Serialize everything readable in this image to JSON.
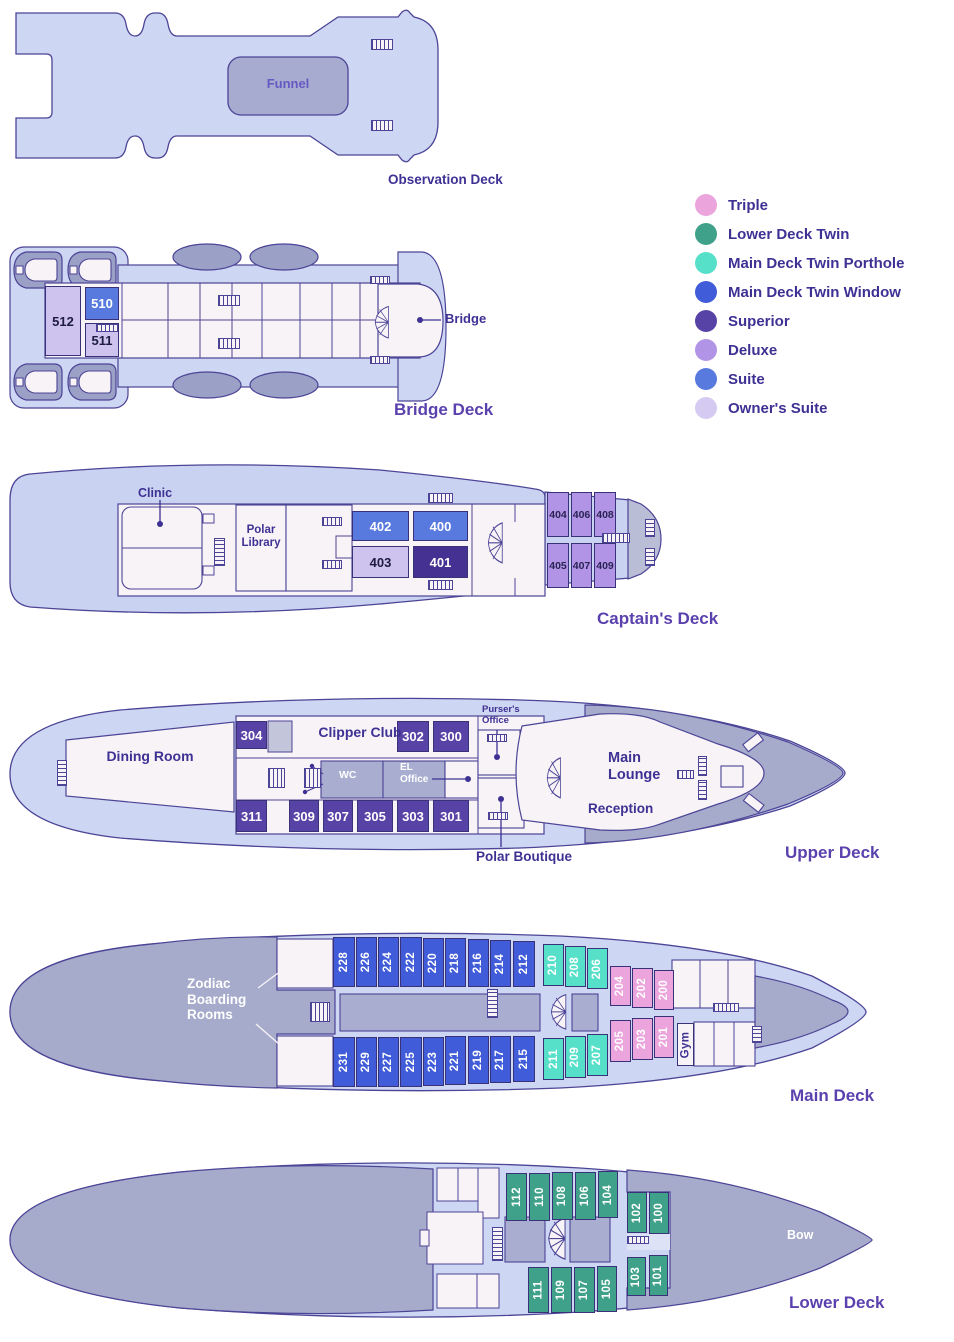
{
  "legend": {
    "items": [
      {
        "label": "Triple",
        "color": "#eba4dc"
      },
      {
        "label": "Lower Deck Twin",
        "color": "#3fa189"
      },
      {
        "label": "Main Deck Twin Porthole",
        "color": "#57e0c9"
      },
      {
        "label": "Main Deck Twin Window",
        "color": "#415cd8"
      },
      {
        "label": "Superior",
        "color": "#5743a6"
      },
      {
        "label": "Deluxe",
        "color": "#b294e6"
      },
      {
        "label": "Suite",
        "color": "#5879de"
      },
      {
        "label": "Owner's Suite",
        "color": "#d5cbf2"
      }
    ]
  },
  "decks": {
    "observation": {
      "title": "Observation Deck",
      "funnel": "Funnel"
    },
    "bridge": {
      "title": "Bridge Deck",
      "bridge_label": "Bridge",
      "cabins": [
        {
          "number": "510",
          "category": "Suite"
        },
        {
          "number": "511",
          "category": "Owner's Suite"
        },
        {
          "number": "512",
          "category": "Owner's Suite"
        }
      ]
    },
    "captains": {
      "title": "Captain's Deck",
      "clinic": "Clinic",
      "polar_library": "Polar Library",
      "cabins": [
        {
          "number": "400",
          "category": "Suite"
        },
        {
          "number": "401",
          "category": "Superior"
        },
        {
          "number": "402",
          "category": "Suite"
        },
        {
          "number": "403",
          "category": "Owner's Suite"
        },
        {
          "number": "404",
          "category": "Deluxe"
        },
        {
          "number": "405",
          "category": "Deluxe"
        },
        {
          "number": "406",
          "category": "Deluxe"
        },
        {
          "number": "407",
          "category": "Deluxe"
        },
        {
          "number": "408",
          "category": "Deluxe"
        },
        {
          "number": "409",
          "category": "Deluxe"
        }
      ]
    },
    "upper": {
      "title": "Upper Deck",
      "dining_room": "Dining Room",
      "clipper_club": "Clipper Club",
      "wc": "WC",
      "el_office": "EL Office",
      "pursers_office": "Purser's Office",
      "main_lounge": "Main Lounge",
      "reception": "Reception",
      "polar_boutique": "Polar Boutique",
      "cabins": [
        {
          "number": "300",
          "category": "Superior"
        },
        {
          "number": "301",
          "category": "Superior"
        },
        {
          "number": "302",
          "category": "Superior"
        },
        {
          "number": "303",
          "category": "Superior"
        },
        {
          "number": "304",
          "category": "Superior"
        },
        {
          "number": "305",
          "category": "Superior"
        },
        {
          "number": "307",
          "category": "Superior"
        },
        {
          "number": "309",
          "category": "Superior"
        },
        {
          "number": "311",
          "category": "Superior"
        }
      ]
    },
    "main": {
      "title": "Main Deck",
      "zodiac": "Zodiac Boarding Rooms",
      "gym": "Gym",
      "cabins_top": [
        {
          "number": "228",
          "category": "Main Deck Twin Window"
        },
        {
          "number": "226",
          "category": "Main Deck Twin Window"
        },
        {
          "number": "224",
          "category": "Main Deck Twin Window"
        },
        {
          "number": "222",
          "category": "Main Deck Twin Window"
        },
        {
          "number": "220",
          "category": "Main Deck Twin Window"
        },
        {
          "number": "218",
          "category": "Main Deck Twin Window"
        },
        {
          "number": "216",
          "category": "Main Deck Twin Window"
        },
        {
          "number": "214",
          "category": "Main Deck Twin Window"
        },
        {
          "number": "212",
          "category": "Main Deck Twin Window"
        },
        {
          "number": "210",
          "category": "Main Deck Twin Porthole"
        },
        {
          "number": "208",
          "category": "Main Deck Twin Porthole"
        },
        {
          "number": "206",
          "category": "Main Deck Twin Porthole"
        },
        {
          "number": "204",
          "category": "Triple"
        },
        {
          "number": "202",
          "category": "Triple"
        },
        {
          "number": "200",
          "category": "Triple"
        }
      ],
      "cabins_bottom": [
        {
          "number": "231",
          "category": "Main Deck Twin Window"
        },
        {
          "number": "229",
          "category": "Main Deck Twin Window"
        },
        {
          "number": "227",
          "category": "Main Deck Twin Window"
        },
        {
          "number": "225",
          "category": "Main Deck Twin Window"
        },
        {
          "number": "223",
          "category": "Main Deck Twin Window"
        },
        {
          "number": "221",
          "category": "Main Deck Twin Window"
        },
        {
          "number": "219",
          "category": "Main Deck Twin Window"
        },
        {
          "number": "217",
          "category": "Main Deck Twin Window"
        },
        {
          "number": "215",
          "category": "Main Deck Twin Window"
        },
        {
          "number": "211",
          "category": "Main Deck Twin Porthole"
        },
        {
          "number": "209",
          "category": "Main Deck Twin Porthole"
        },
        {
          "number": "207",
          "category": "Main Deck Twin Porthole"
        },
        {
          "number": "205",
          "category": "Triple"
        },
        {
          "number": "203",
          "category": "Triple"
        },
        {
          "number": "201",
          "category": "Triple"
        }
      ]
    },
    "lower": {
      "title": "Lower Deck",
      "bow": "Bow",
      "cabins_top": [
        {
          "number": "112",
          "category": "Lower Deck Twin"
        },
        {
          "number": "110",
          "category": "Lower Deck Twin"
        },
        {
          "number": "108",
          "category": "Lower Deck Twin"
        },
        {
          "number": "106",
          "category": "Lower Deck Twin"
        },
        {
          "number": "104",
          "category": "Lower Deck Twin"
        },
        {
          "number": "102",
          "category": "Lower Deck Twin"
        },
        {
          "number": "100",
          "category": "Lower Deck Twin"
        }
      ],
      "cabins_bottom": [
        {
          "number": "111",
          "category": "Lower Deck Twin"
        },
        {
          "number": "109",
          "category": "Lower Deck Twin"
        },
        {
          "number": "107",
          "category": "Lower Deck Twin"
        },
        {
          "number": "105",
          "category": "Lower Deck Twin"
        },
        {
          "number": "103",
          "category": "Lower Deck Twin"
        },
        {
          "number": "101",
          "category": "Lower Deck Twin"
        }
      ]
    }
  }
}
